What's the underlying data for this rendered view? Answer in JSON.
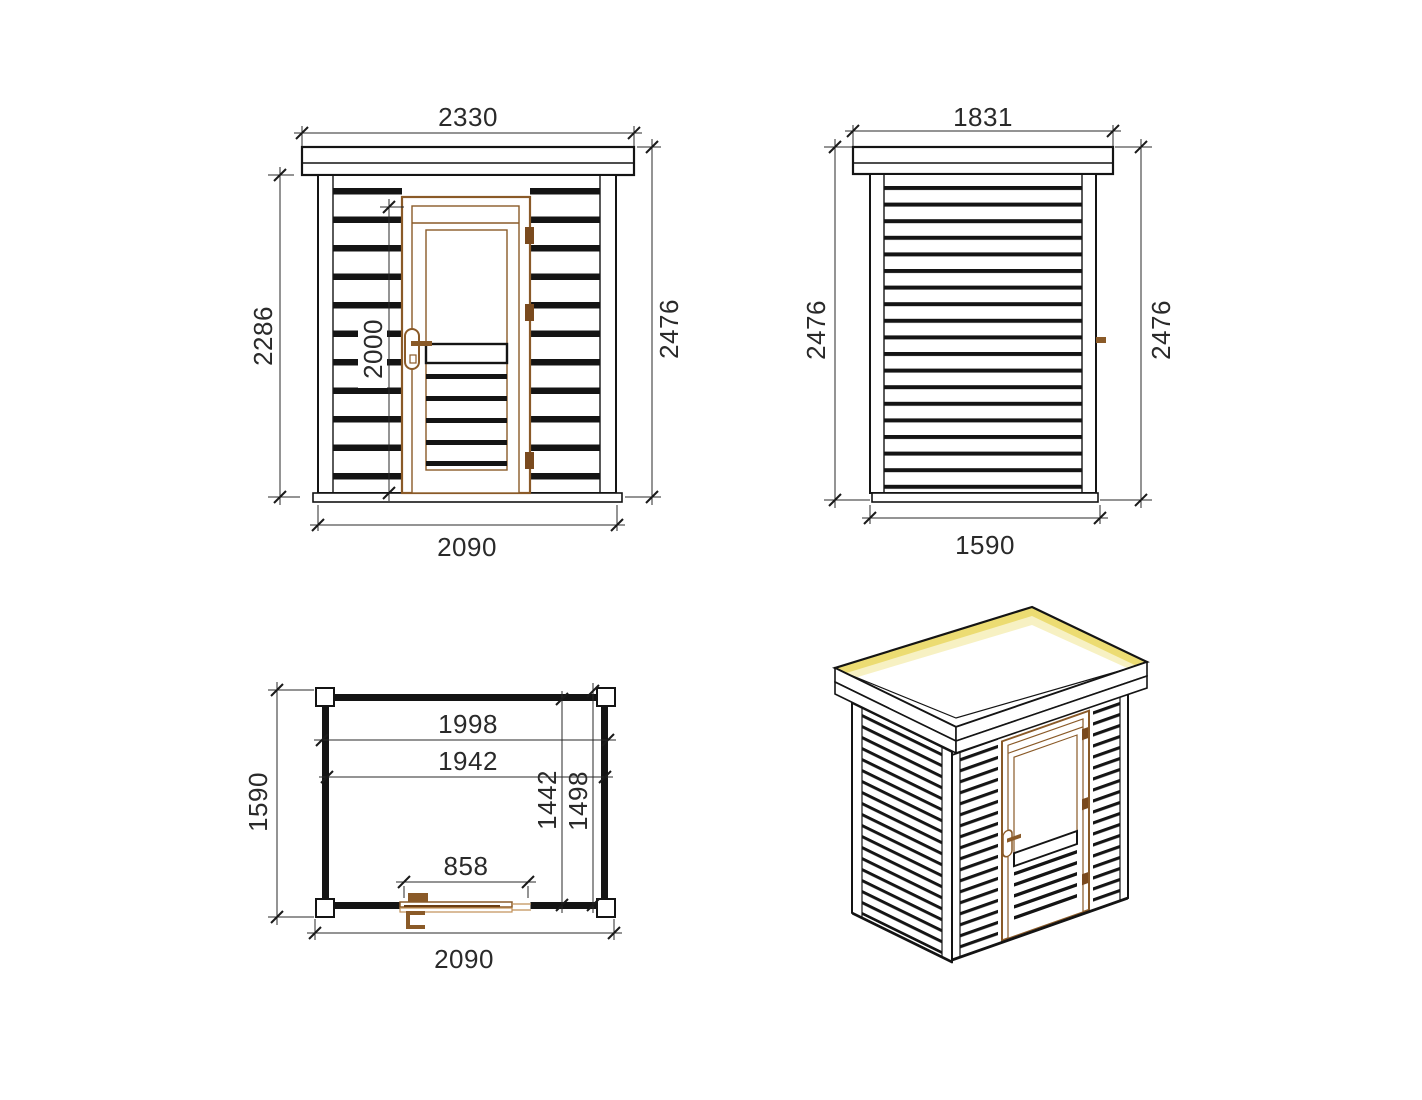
{
  "drawing": {
    "title": "garden-shed-technical-drawing",
    "views": {
      "front_elevation": {
        "name": "front elevation",
        "dims": {
          "roof_width": "2330",
          "wall_height": "2286",
          "door_height": "2000",
          "total_height": "2476",
          "base_width": "2090"
        }
      },
      "side_elevation": {
        "name": "side elevation",
        "dims": {
          "roof_depth": "1831",
          "height_left": "2476",
          "height_right": "2476",
          "base_depth": "1590"
        }
      },
      "floor_plan": {
        "name": "floor plan",
        "dims": {
          "inner_width_a": "1998",
          "inner_width_b": "1942",
          "inner_depth_a": "1442",
          "inner_depth_b": "1498",
          "door_opening": "858",
          "plan_depth": "1590",
          "plan_width": "2090"
        }
      },
      "isometric": {
        "name": "3d isometric view"
      }
    },
    "colors": {
      "line": "#141414",
      "door_brown": "#8a5a28",
      "hinge_brown": "#7a4a1e",
      "tan": "#c09058",
      "roof_glow": "#ecdc72",
      "roof_glow_soft": "#f7f1c3"
    }
  }
}
